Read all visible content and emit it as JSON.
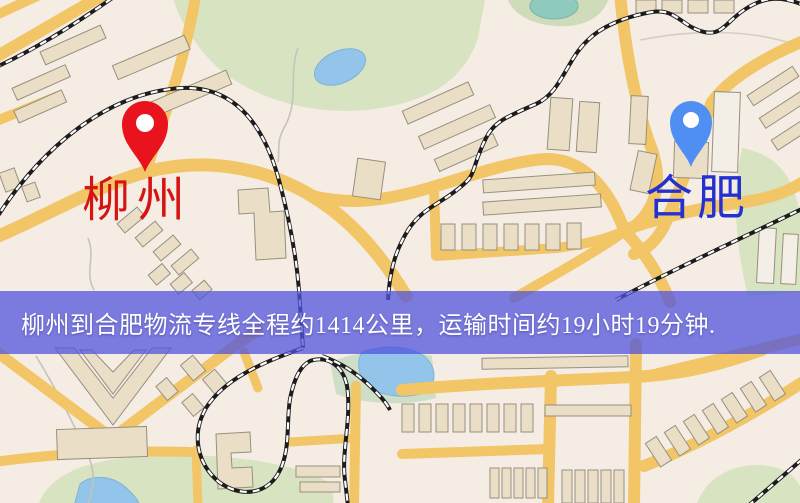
{
  "map": {
    "origin": {
      "label": "柳州",
      "pin_color": "#e8131d",
      "label_color": "#d51414"
    },
    "destination": {
      "label": "合肥",
      "pin_color": "#4f8ef3",
      "label_color": "#2531cf"
    },
    "banner": {
      "text": "柳州到合肥物流专线全程约1414公里，运输时间约19小时19分钟.",
      "background_color": "#5054de",
      "text_color": "#ffffff"
    },
    "route": {
      "distance_km": "1414",
      "duration": "19小时19分钟"
    },
    "palette": {
      "map_background": "#f5ece4",
      "road": "#f2c566",
      "building": "#eadfc6",
      "park": "#d8e3c1",
      "water": "#93c4ea",
      "railway": "#1c1c1c"
    }
  }
}
